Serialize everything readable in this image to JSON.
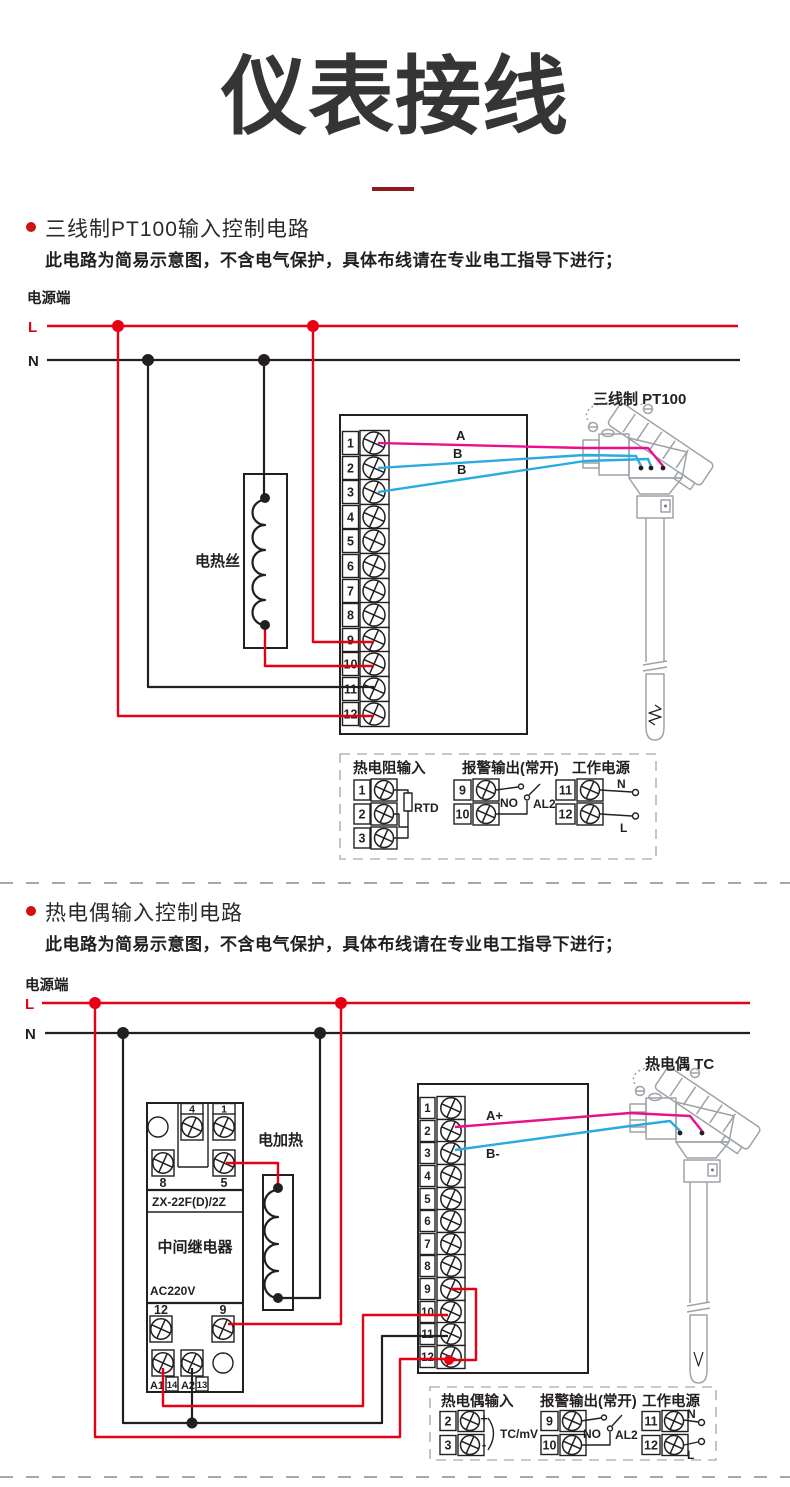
{
  "page": {
    "title": "仪表接线"
  },
  "s1": {
    "heading": "三线制PT100输入控制电路",
    "note": "此电路为简易示意图，不含电气保护，具体布线请在专业电工指导下进行；",
    "power_label": "电源端",
    "l": "L",
    "n": "N",
    "heater": "电热丝",
    "sensor": "三线制 PT100",
    "wires": [
      "A",
      "B",
      "B"
    ],
    "terminals": [
      "1",
      "2",
      "3",
      "4",
      "5",
      "6",
      "7",
      "8",
      "9",
      "10",
      "11",
      "12"
    ],
    "legend": {
      "g1": {
        "title": "热电阻输入",
        "t": [
          "1",
          "2",
          "3"
        ],
        "comp": "RTD"
      },
      "g2": {
        "title": "报警输出(常开)",
        "t": [
          "9",
          "10"
        ],
        "no": "NO",
        "al": "AL2"
      },
      "g3": {
        "title": "工作电源",
        "t": [
          "11",
          "12"
        ],
        "n": "N",
        "l": "L"
      }
    }
  },
  "s2": {
    "heading": "热电偶输入控制电路",
    "note": "此电路为简易示意图，不含电气保护，具体布线请在专业电工指导下进行；",
    "power_label": "电源端",
    "l": "L",
    "n": "N",
    "heater": "电加热",
    "sensor": "热电偶 TC",
    "wires": [
      "A+",
      "B-"
    ],
    "relay": {
      "model": "ZX-22F(D)/2Z",
      "name": "中间继电器",
      "voltage": "AC220V",
      "top": [
        "4",
        "1"
      ],
      "mid": [
        "8",
        "5"
      ],
      "bot": [
        "12",
        "9"
      ],
      "pins": [
        "A1",
        "14",
        "A2",
        "13"
      ]
    },
    "terminals": [
      "1",
      "2",
      "3",
      "4",
      "5",
      "6",
      "7",
      "8",
      "9",
      "10",
      "11",
      "12"
    ],
    "legend": {
      "g1": {
        "title": "热电偶输入",
        "t": [
          "2",
          "3"
        ],
        "plus": "+",
        "minus": "-",
        "comp": "TC/mV"
      },
      "g2": {
        "title": "报警输出(常开)",
        "t": [
          "9",
          "10"
        ],
        "no": "NO",
        "al": "AL2"
      },
      "g3": {
        "title": "工作电源",
        "t": [
          "11",
          "12"
        ],
        "n": "N",
        "l": "L"
      }
    }
  },
  "colors": {
    "power_red": "#e60012",
    "wire_magenta": "#ec0f8b",
    "wire_cyan": "#29abe2",
    "ink": "#231f20",
    "accent": "#8e1b1e"
  }
}
